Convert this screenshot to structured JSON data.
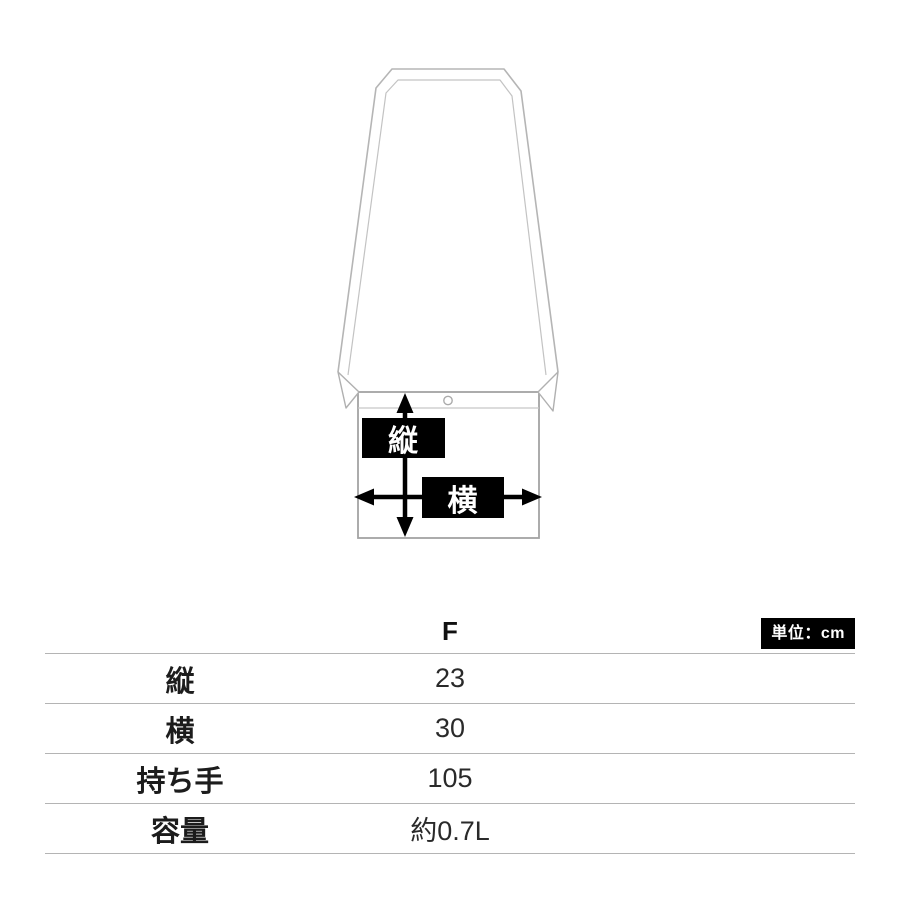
{
  "diagram": {
    "vertical_label": "縦",
    "horizontal_label": "横",
    "label_bg": "#000000",
    "label_text_color": "#ffffff",
    "strap_line_color": "#b5b5b5",
    "bag_outline_color": "#a3a3a3",
    "arrow_color": "#000000"
  },
  "table": {
    "size_header": "F",
    "unit_badge": "単位：cm",
    "unit_badge_bg": "#000000",
    "unit_badge_text_color": "#ffffff",
    "rule_color": "#b4b4b4",
    "rows": [
      {
        "label": "縦",
        "value": "23"
      },
      {
        "label": "横",
        "value": "30"
      },
      {
        "label": "持ち手",
        "value": "105"
      },
      {
        "label": "容量",
        "value": "約0.7L"
      }
    ]
  }
}
